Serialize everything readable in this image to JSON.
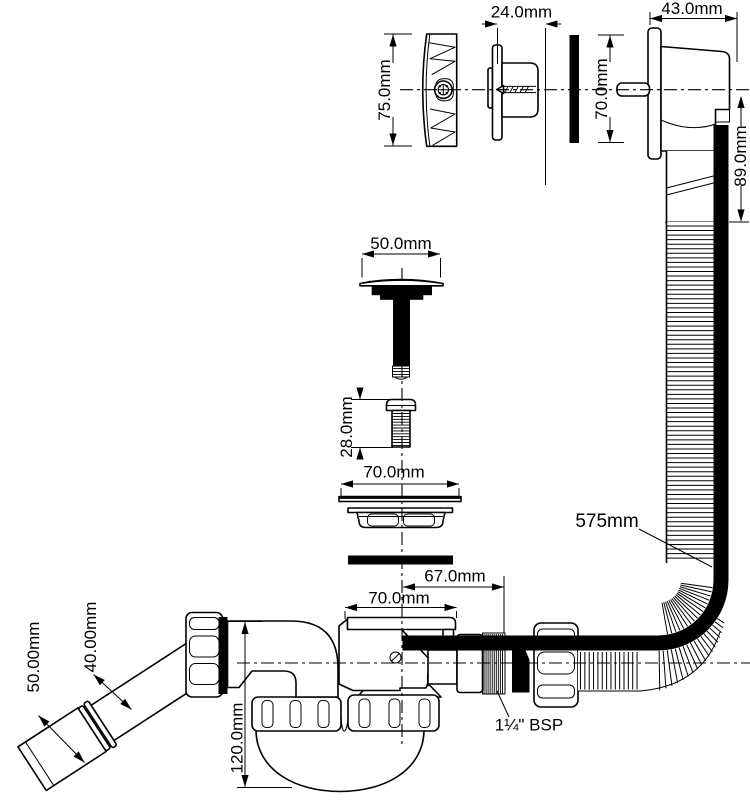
{
  "colors": {
    "line": "#000000",
    "background": "#ffffff"
  },
  "labels": {
    "cover_plate_height": "75.0mm",
    "overflow_body_depth": "24.0mm",
    "housing_depth": "43.0mm",
    "housing_height": "70.0mm",
    "housing_drop": "89.0mm",
    "plug_diameter": "50.0mm",
    "screw_length": "28.0mm",
    "flange_diameter": "70.0mm",
    "hose_length": "575mm",
    "outlet_offset": "67.0mm",
    "trap_flange_width": "70.0mm",
    "trap_height": "120.0mm",
    "pipe_outer_diameter": "50.00mm",
    "pipe_inner_diameter": "40.00mm",
    "thread_size": "1¼\" BSP"
  }
}
